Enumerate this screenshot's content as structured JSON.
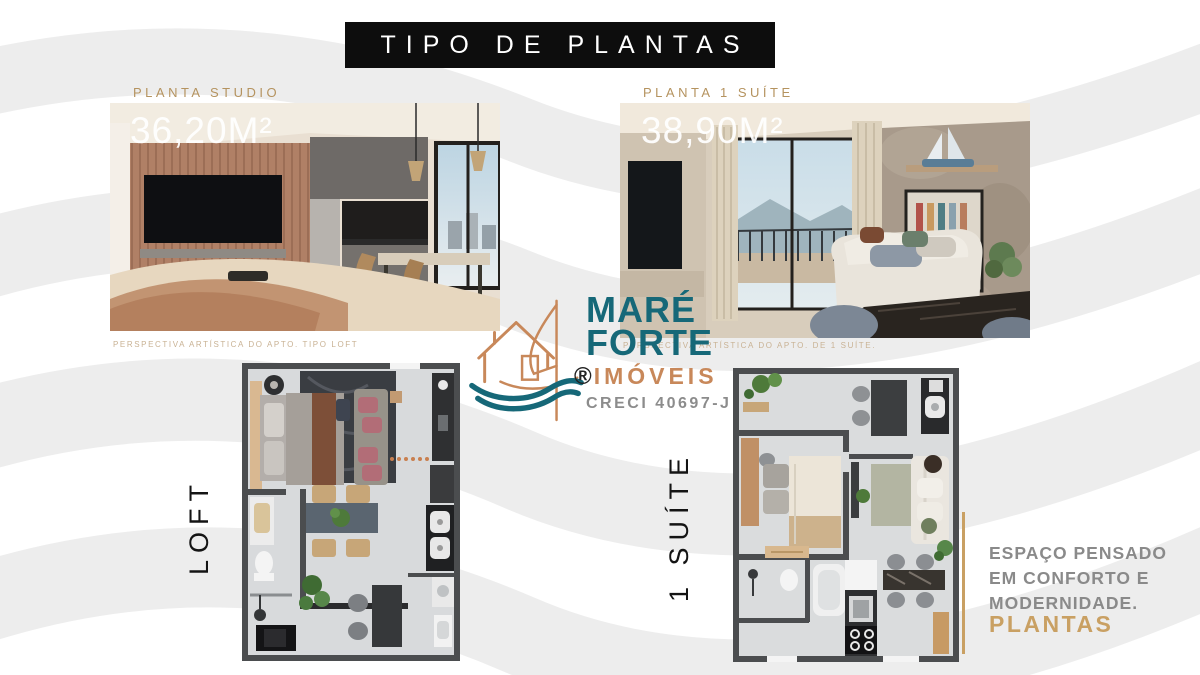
{
  "header": {
    "title": "TIPO DE PLANTAS"
  },
  "units": [
    {
      "plan_type_label": "PLANTA STUDIO",
      "area": "36,20M²",
      "caption": "PERSPECTIVA ARTÍSTICA DO APTO. TIPO LOFT",
      "floorplan_label": "LOFT"
    },
    {
      "plan_type_label": "PLANTA 1 SUÍTE",
      "area": "38,90M²",
      "caption": "PERSPECTIVA ARTÍSTICA DO APTO. DE 1 SUÍTE.",
      "floorplan_label": "1 SUÍTE"
    }
  ],
  "logo": {
    "name_line1": "MARÉ",
    "name_line2": "FORTE",
    "registered_mark": "®",
    "subtitle": "IMÓVEIS",
    "license": "CRECI 40697-J",
    "icon": "house-sail-waves-icon",
    "colors": {
      "teal": "#166878",
      "orange": "#c8885a",
      "gray": "#8c8c8c"
    }
  },
  "footer": {
    "tagline_lines": [
      "ESPAÇO PENSADO",
      "EM CONFORTO E",
      "MODERNIDADE."
    ],
    "highlight": "PLANTAS",
    "accent_color": "#c9a063"
  },
  "style": {
    "accent_gold": "#b5935f",
    "background": "#ffffff",
    "wave_color": "#ededed",
    "title_bg": "#0d0d0d",
    "title_color": "#ffffff"
  }
}
